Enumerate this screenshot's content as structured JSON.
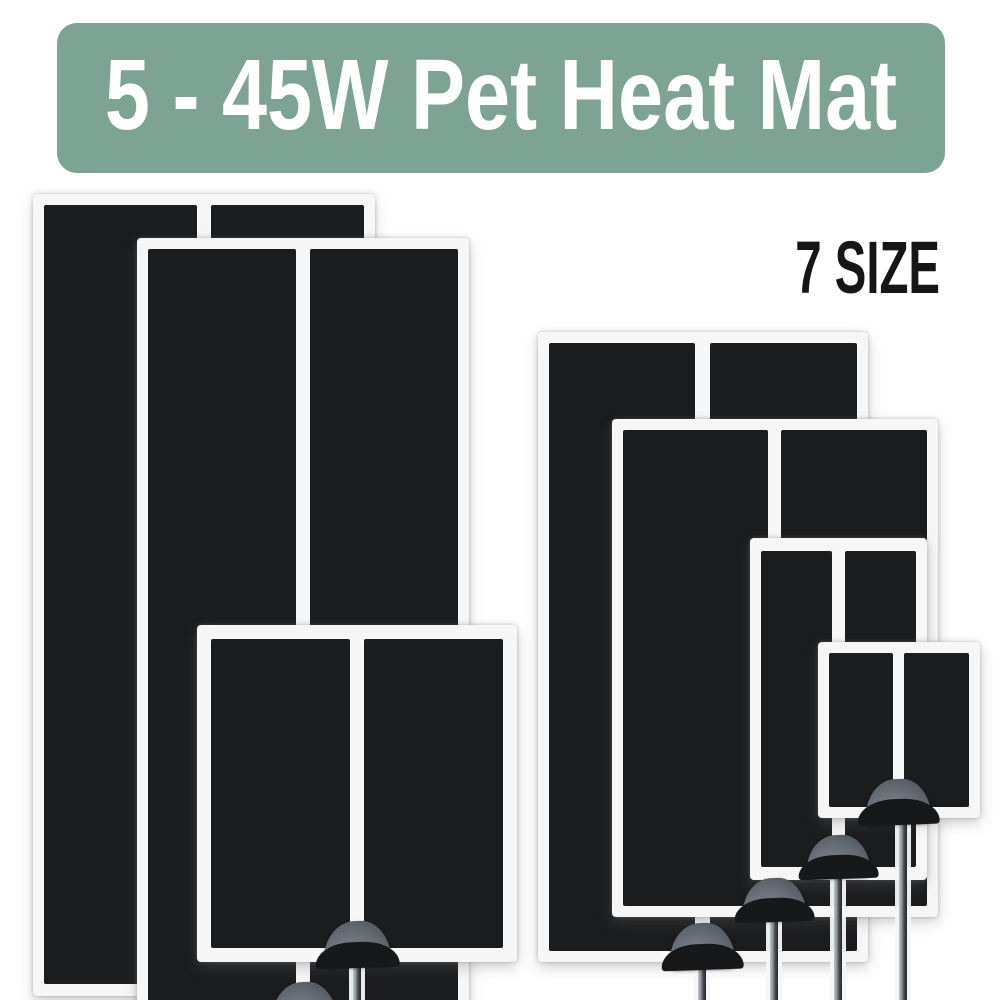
{
  "banner": {
    "title": "5 - 45W Pet Heat Mat",
    "bg_color": "#7ca394",
    "text_color": "#ffffff"
  },
  "size_badge": {
    "label": "7 SIZE",
    "text_color": "#161616"
  },
  "product": {
    "mat_count": 7,
    "mats": [
      {
        "name": "mat-1",
        "placement": "back left, tallest, knob hidden"
      },
      {
        "name": "mat-2",
        "placement": "front left, knob cut off at bottom edge"
      },
      {
        "name": "mat-3",
        "placement": "lower left, overlaps mat-2"
      },
      {
        "name": "mat-4",
        "placement": "back of right group, largest on right"
      },
      {
        "name": "mat-5",
        "placement": "right group, second largest"
      },
      {
        "name": "mat-6",
        "placement": "right group, third"
      },
      {
        "name": "mat-7",
        "placement": "front right, smallest"
      }
    ]
  },
  "colors": {
    "background": "#ffffff",
    "card": "#f6f6f6",
    "panel": "#1b1c1e",
    "accent": "#7ca394",
    "knob_light": "#767d84",
    "knob_dark": "#383e44",
    "cable_light": "#c2c6ca",
    "cable_dark": "#24272b"
  }
}
